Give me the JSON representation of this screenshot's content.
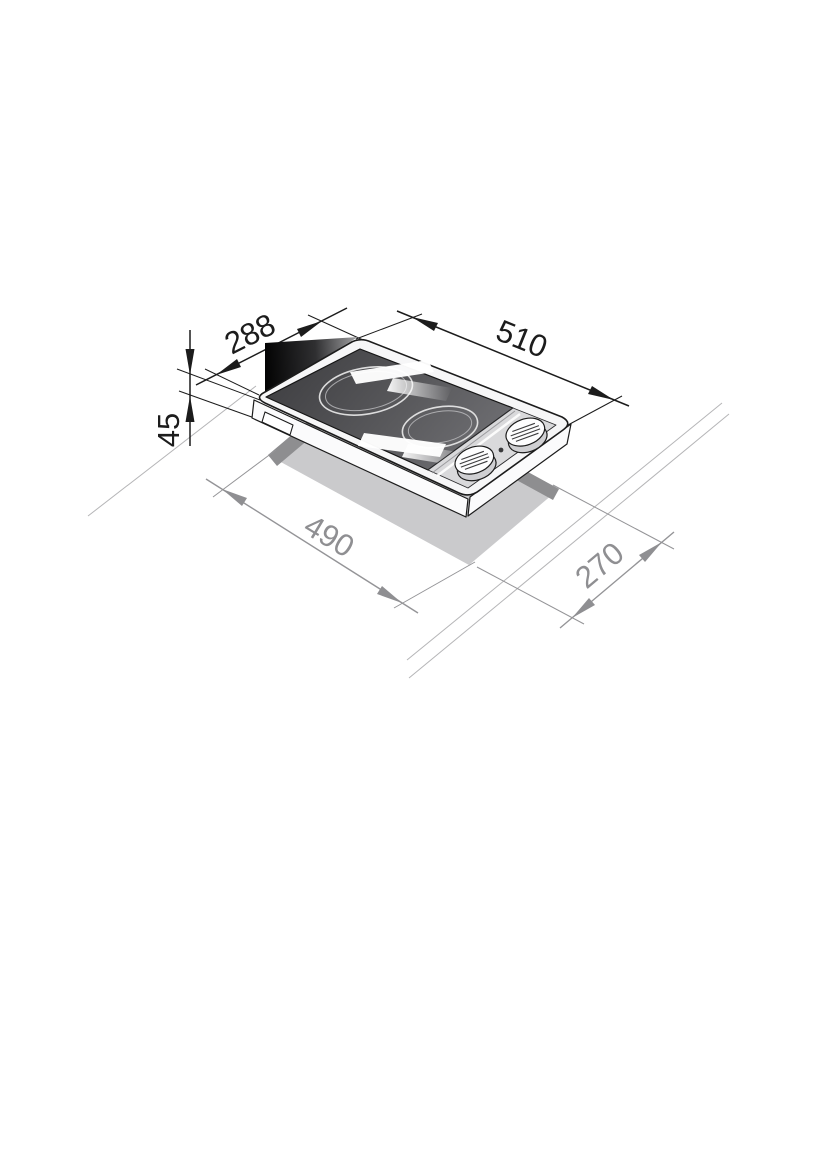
{
  "diagram": {
    "kind": "installation-dimension-drawing",
    "product": "two-zone ceramic domino hob, isometric view over worktop cutout",
    "dimensions": {
      "hob_width": {
        "value": "288",
        "role": "hob top depth (front-to-back of top frame)"
      },
      "hob_length": {
        "value": "510",
        "role": "hob top length (left-to-right of top frame)"
      },
      "hob_height": {
        "value": "45",
        "role": "hob body height below frame"
      },
      "cutout_length": {
        "value": "490",
        "role": "worktop cutout length"
      },
      "cutout_width": {
        "value": "270",
        "role": "worktop cutout width"
      }
    },
    "features": {
      "burners": 2,
      "control_knobs": 2,
      "indicator_light": 1
    },
    "colors": {
      "dimension_primary": "#1c1c1c",
      "dimension_secondary": "#8f8f92",
      "worktop_line": "#b5b5b7",
      "cutout_fill": "#cacacc",
      "cutout_shadow_band": "#8e8e90",
      "glass_dark": "#414144",
      "glass_light": "#707074",
      "frame_fill": "#f6f6f7",
      "panel_fill": "#d9d9db"
    }
  }
}
